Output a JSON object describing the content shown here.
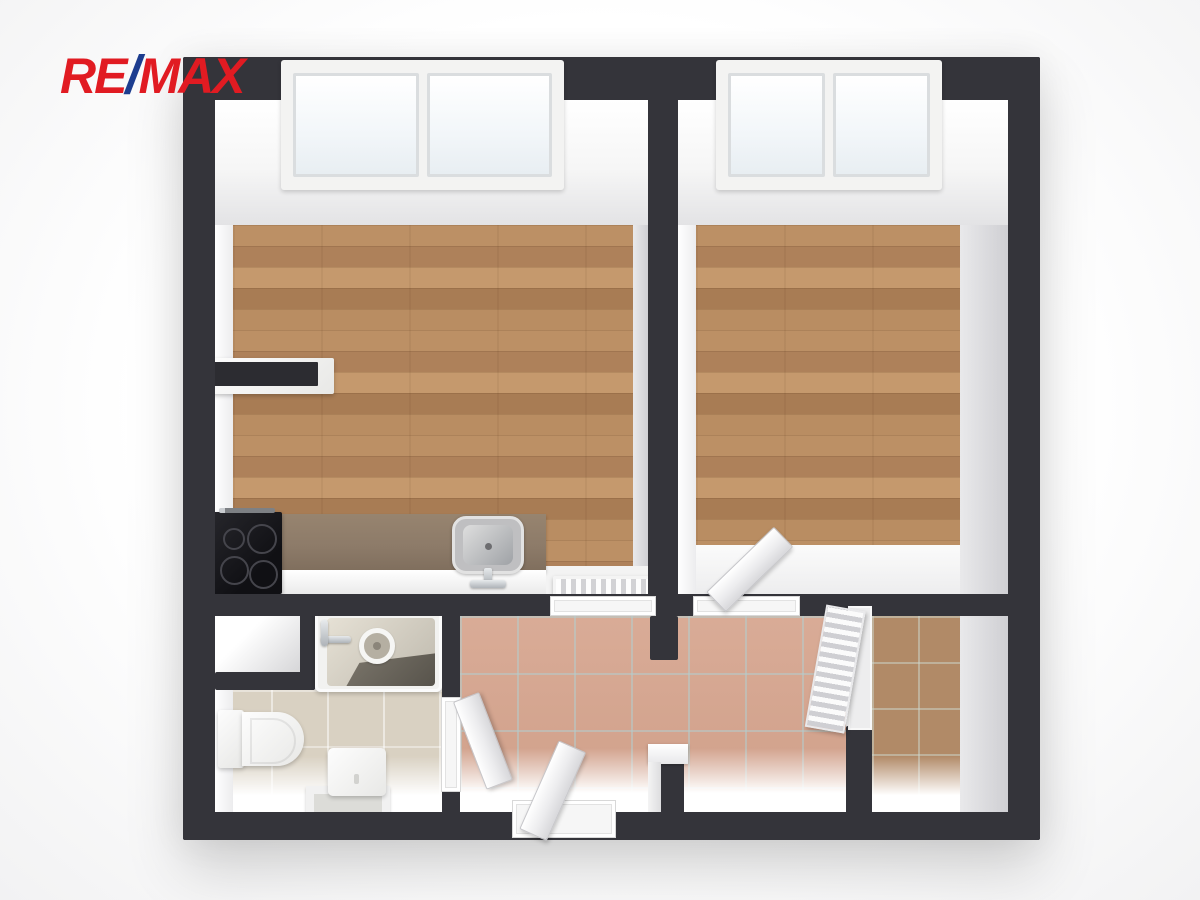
{
  "logo": {
    "re": "RE",
    "slash": "/",
    "max": "MAX"
  },
  "palette": {
    "wall": "#34343a",
    "logo_red": "#e11b22",
    "logo_blue": "#1d3d8f",
    "wood": "#b88c60",
    "tile_hall": "#d7a791",
    "tile_bath": "#d9d1c2",
    "tile_storage": "#b18a67",
    "counter": "#8d7b69",
    "stove": "#16161a",
    "fixture_white": "#f5f5f5"
  },
  "fixtures": {
    "left_room": [
      "window",
      "wall-shelf",
      "kitchen-counter",
      "stove",
      "kitchen-sink",
      "radiator"
    ],
    "right_room": [
      "window",
      "open-door"
    ],
    "bathroom": [
      "bathtub",
      "bath-faucet",
      "toilet",
      "washing-machine",
      "door"
    ],
    "hallway": [
      "entrance-door"
    ],
    "storage_room": [
      "louvered-door"
    ]
  }
}
